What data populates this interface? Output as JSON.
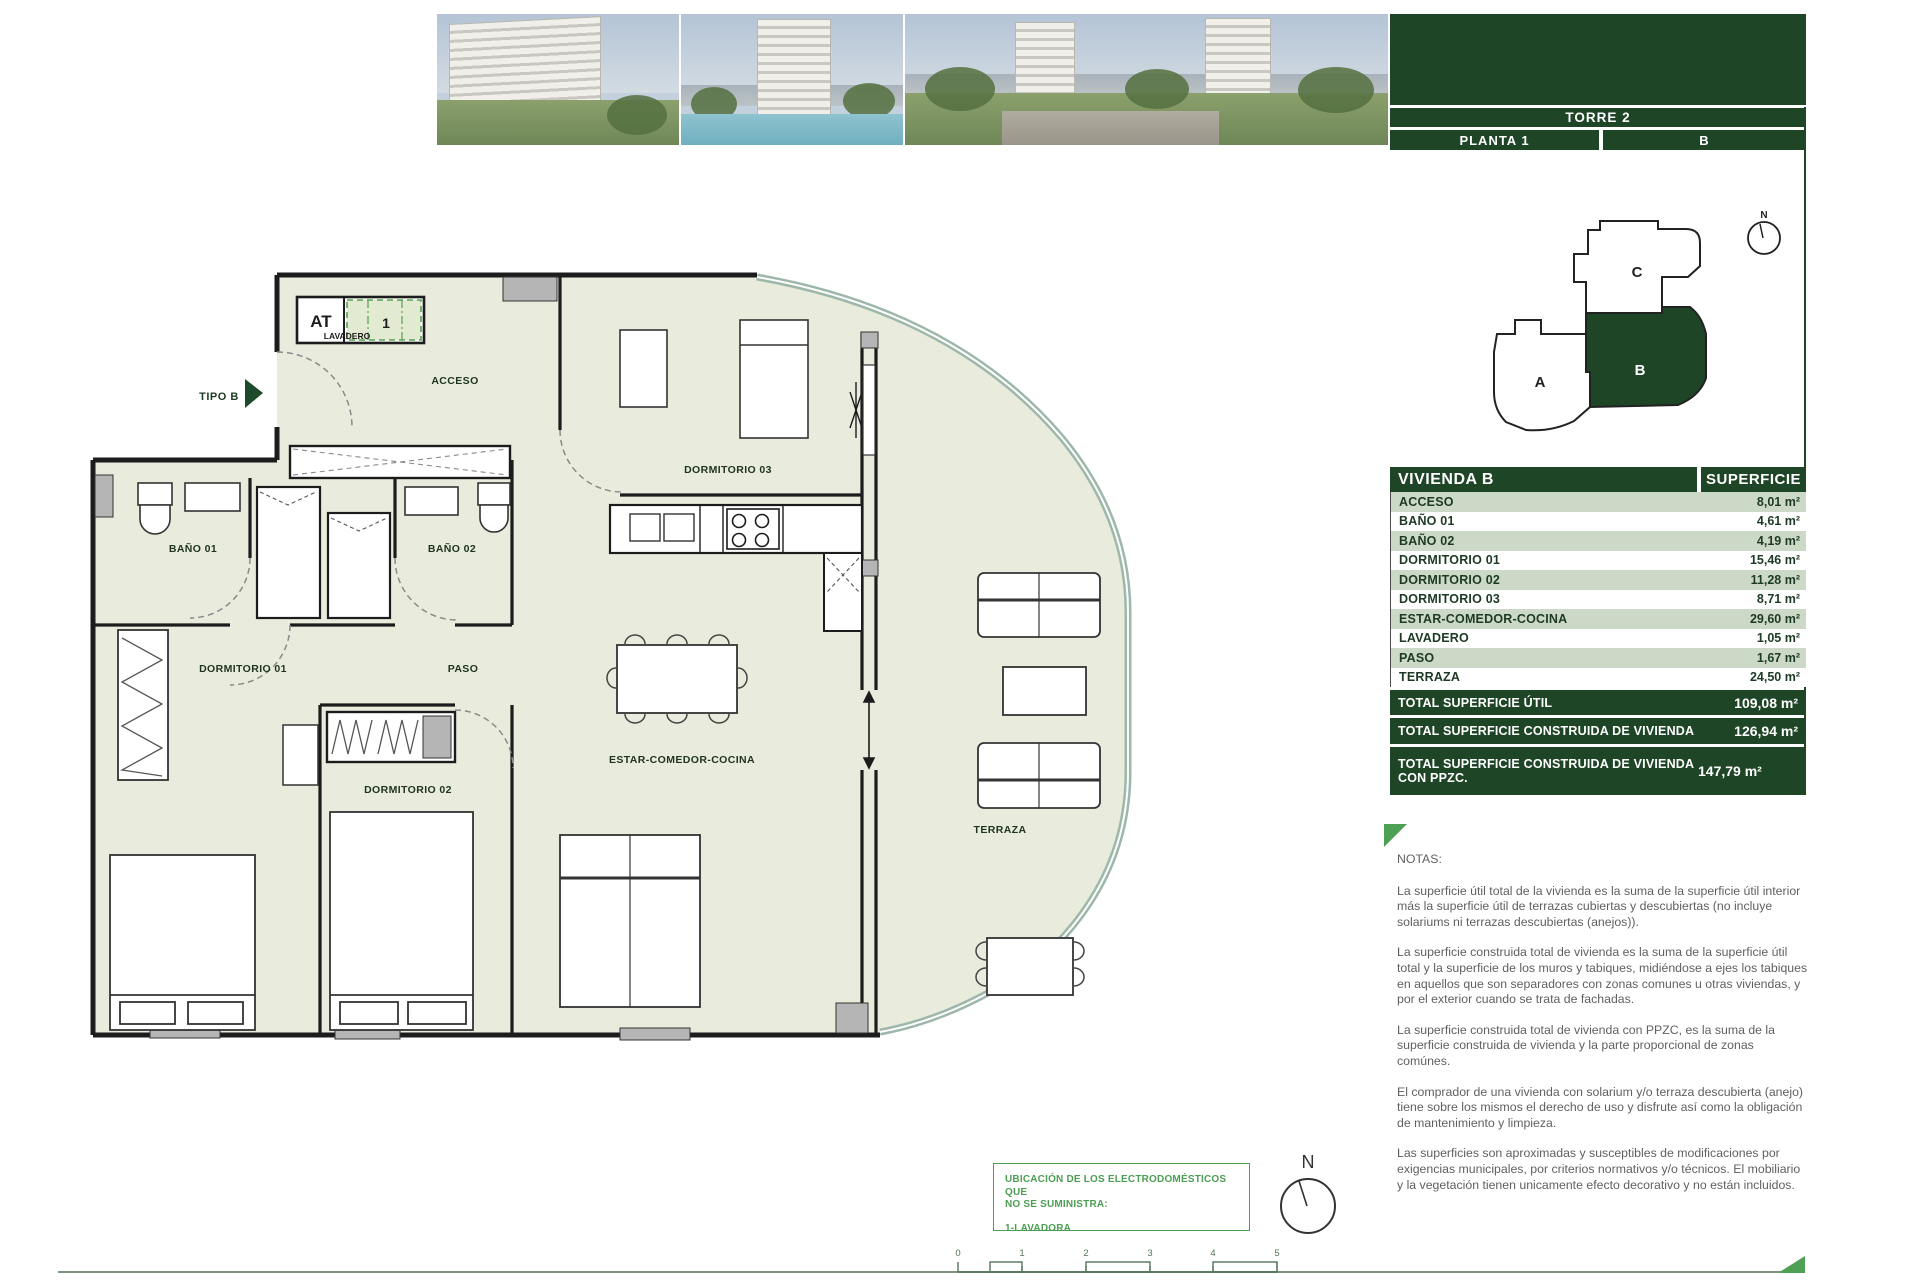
{
  "panel": {
    "torre": "TORRE 2",
    "planta": "PLANTA 1",
    "letter": "B",
    "keyplan": {
      "a": "A",
      "b": "B",
      "c": "C"
    }
  },
  "compass": {
    "n": "N"
  },
  "table": {
    "header": {
      "left": "VIVIENDA B",
      "right": "SUPERFICIE"
    },
    "rows": [
      {
        "label": "ACCESO",
        "value": "8,01 m²"
      },
      {
        "label": "BAÑO 01",
        "value": "4,61 m²"
      },
      {
        "label": "BAÑO 02",
        "value": "4,19 m²"
      },
      {
        "label": "DORMITORIO 01",
        "value": "15,46 m²"
      },
      {
        "label": "DORMITORIO 02",
        "value": "11,28 m²"
      },
      {
        "label": "DORMITORIO 03",
        "value": "8,71 m²"
      },
      {
        "label": "ESTAR-COMEDOR-COCINA",
        "value": "29,60 m²"
      },
      {
        "label": "LAVADERO",
        "value": "1,05 m²"
      },
      {
        "label": "PASO",
        "value": "1,67 m²"
      },
      {
        "label": "TERRAZA",
        "value": "24,50 m²"
      }
    ],
    "totals": [
      {
        "label": "TOTAL SUPERFICIE ÚTIL",
        "value": "109,08 m²"
      },
      {
        "label": "TOTAL SUPERFICIE CONSTRUIDA DE VIVIENDA",
        "value": "126,94 m²"
      },
      {
        "label": "TOTAL SUPERFICIE CONSTRUIDA DE VIVIENDA CON PPZC.",
        "value": "147,79 m²"
      }
    ]
  },
  "notes": {
    "title": "NOTAS:",
    "paragraphs": [
      "La superficie útil total de la vivienda es la suma de la superficie útil interior más la superficie útil de terrazas cubiertas y descubiertas (no incluye solariums ni terrazas descubiertas (anejos)).",
      "La superficie construida total de vivienda es la suma de la superficie útil total y la superficie de los muros y tabiques, midiéndose a ejes los tabiques en aquellos que son separadores con zonas comunes u otras viviendas, y por el exterior cuando se trata de fachadas.",
      "La superficie construida total de vivienda con PPZC, es la suma de la superficie construida de vivienda y la parte proporcional de zonas comúnes.",
      "El comprador de una vivienda con solarium y/o terraza descubierta (anejo) tiene sobre los mismos el derecho de uso y disfrute así como la obligación de mantenimiento y limpieza.",
      "Las superficies son aproximadas y susceptibles de modificaciones por exigencias municipales, por criterios normativos y/o técnicos. El mobiliario y la vegetación tienen unicamente efecto decorativo y no están incluidos."
    ]
  },
  "plan": {
    "tipo": "TIPO B",
    "at": "AT",
    "lavadero": "LAVADERO",
    "one": "1",
    "rooms": {
      "acceso": "ACCESO",
      "dormitorio03": "DORMITORIO 03",
      "bano01": "BAÑO 01",
      "bano02": "BAÑO 02",
      "dormitorio01": "DORMITORIO 01",
      "paso": "PASO",
      "dormitorio02": "DORMITORIO 02",
      "estar": "ESTAR-COMEDOR-COCINA",
      "terraza": "TERRAZA"
    }
  },
  "appliances": {
    "line1": "UBICACIÓN DE LOS ELECTRODOMÉSTICOS QUE",
    "line2": "NO SE SUMINISTRA:",
    "item": "1-LAVADORA"
  },
  "scalebar": {
    "ticks": [
      "0",
      "1",
      "2",
      "3",
      "4",
      "5"
    ]
  }
}
